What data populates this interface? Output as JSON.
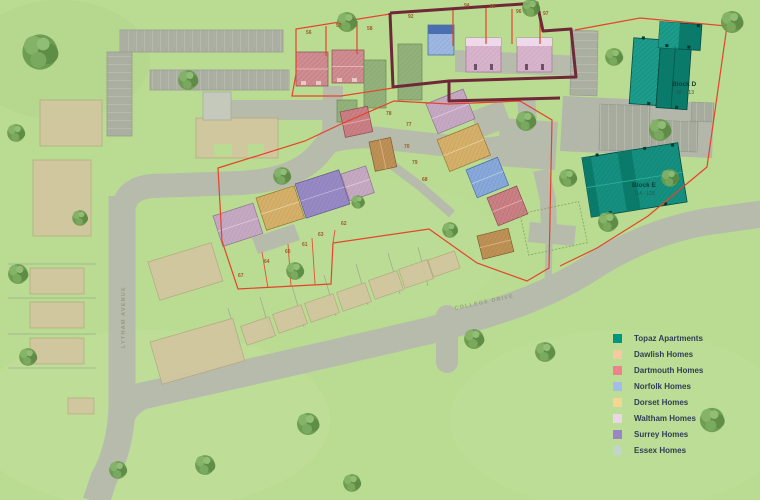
{
  "map": {
    "background_color": "#b9db92",
    "boundary_colors": {
      "site_outline": "#6f2837",
      "plot_outline": "#e6432b"
    },
    "blocks": [
      {
        "name": "Block D",
        "plots": "98 - 113"
      },
      {
        "name": "Block E",
        "plots": "114 - 129"
      }
    ],
    "roads": [
      {
        "name": "LYTHAM AVENUE"
      },
      {
        "name": "COLLEGE DRIVE"
      }
    ],
    "plot_numbers": [
      {
        "n": "56",
        "x": 306,
        "y": 34
      },
      {
        "n": "57",
        "x": 336,
        "y": 27
      },
      {
        "n": "58",
        "x": 367,
        "y": 30
      },
      {
        "n": "92",
        "x": 408,
        "y": 18
      },
      {
        "n": "94",
        "x": 464,
        "y": 7
      },
      {
        "n": "95",
        "x": 490,
        "y": 8
      },
      {
        "n": "96",
        "x": 516,
        "y": 13
      },
      {
        "n": "97",
        "x": 543,
        "y": 15
      },
      {
        "n": "78",
        "x": 386,
        "y": 115
      },
      {
        "n": "77",
        "x": 406,
        "y": 126
      },
      {
        "n": "70",
        "x": 404,
        "y": 148
      },
      {
        "n": "79",
        "x": 412,
        "y": 164
      },
      {
        "n": "68",
        "x": 422,
        "y": 181
      },
      {
        "n": "61",
        "x": 302,
        "y": 246
      },
      {
        "n": "62",
        "x": 341,
        "y": 225
      },
      {
        "n": "63",
        "x": 318,
        "y": 236
      },
      {
        "n": "64",
        "x": 264,
        "y": 263
      },
      {
        "n": "65",
        "x": 285,
        "y": 253
      },
      {
        "n": "67",
        "x": 238,
        "y": 277
      }
    ]
  },
  "legend": {
    "items": [
      {
        "label": "Topaz Apartments",
        "color": "#00957f"
      },
      {
        "label": "Dawlish Homes",
        "color": "#f6c9a0"
      },
      {
        "label": "Dartmouth Homes",
        "color": "#f0808e"
      },
      {
        "label": "Norfolk Homes",
        "color": "#a3bce8"
      },
      {
        "label": "Dorset Homes",
        "color": "#f6d593"
      },
      {
        "label": "Waltham Homes",
        "color": "#ebd6e6"
      },
      {
        "label": "Surrey Homes",
        "color": "#9a86c6"
      },
      {
        "label": "Essex Homes",
        "color": "#c2d5cd"
      }
    ]
  }
}
